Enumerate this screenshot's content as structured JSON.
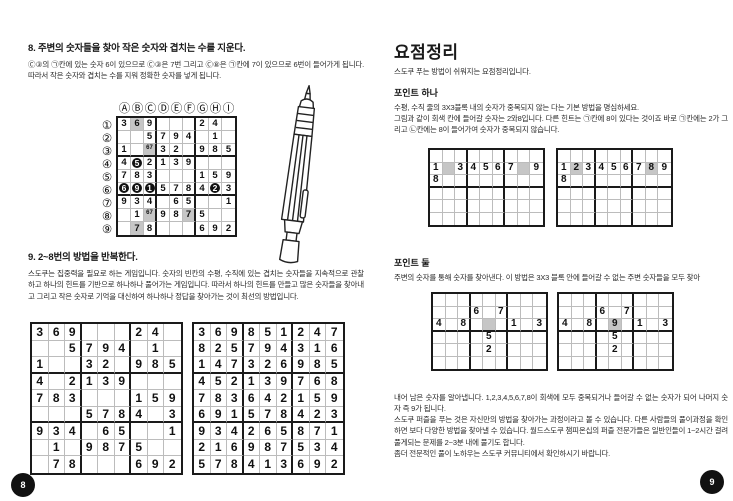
{
  "colors": {
    "shaded_cell": "#c6c6c6",
    "black_disc": "#111111",
    "page_badge": "#111111"
  },
  "left_page": {
    "section8": {
      "heading": "8. 주변의 숫자들을 찾아 작은 숫자와 겹치는 수를 지운다.",
      "body": "Ⓒ③의 ㉠칸에 있는 숫자 6이 있으므로 Ⓒ③은 7번 그리고 Ⓒ⑧은 ㉠칸에 7이 있으므로 6번이 들어가게 됩니다. 따라서 작은 숫자와 겹치는 수를 지워 정확한 숫자를 넣게 됩니다."
    },
    "labeled_grid": {
      "col_headers": [
        "Ⓐ",
        "Ⓑ",
        "Ⓒ",
        "Ⓓ",
        "Ⓔ",
        "Ⓕ",
        "Ⓖ",
        "Ⓗ",
        "Ⓘ"
      ],
      "row_headers": [
        "①",
        "②",
        "③",
        "④",
        "⑤",
        "⑥",
        "⑦",
        "⑧",
        "⑨"
      ],
      "cells": [
        [
          "3",
          "6",
          "9",
          "",
          "",
          "",
          "2",
          "4",
          ""
        ],
        [
          "",
          "",
          "5",
          "7",
          "9",
          "4",
          "",
          "1",
          ""
        ],
        [
          "1",
          "",
          "",
          "3",
          "2",
          "",
          "9",
          "8",
          "5"
        ],
        [
          "4",
          "5",
          "2",
          "1",
          "3",
          "9",
          "",
          "",
          ""
        ],
        [
          "7",
          "8",
          "3",
          "",
          "",
          "",
          "1",
          "5",
          "9"
        ],
        [
          "6",
          "9",
          "1",
          "5",
          "7",
          "8",
          "4",
          "2",
          "3"
        ],
        [
          "9",
          "3",
          "4",
          "",
          "6",
          "5",
          "",
          "",
          "1"
        ],
        [
          "",
          "1",
          "",
          "9",
          "8",
          "7",
          "5",
          "",
          ""
        ],
        [
          "",
          "7",
          "8",
          "",
          "",
          "",
          "6",
          "9",
          "2"
        ]
      ],
      "shaded": [
        [
          0,
          1
        ],
        [
          2,
          2
        ],
        [
          7,
          2
        ],
        [
          7,
          5
        ],
        [
          8,
          1
        ]
      ],
      "black": [
        [
          3,
          1
        ],
        [
          5,
          0
        ],
        [
          5,
          1
        ],
        [
          5,
          2
        ],
        [
          5,
          7
        ]
      ],
      "marks": [
        [
          2,
          2,
          "67"
        ],
        [
          7,
          2,
          "67"
        ]
      ]
    },
    "section9": {
      "heading": "9. 2~8번의 방법을 반복한다.",
      "body": "스도쿠는 집중력을 필요로 하는 게임입니다. 숫자의 빈칸의 수평, 수직에 있는 겹치는 숫자들을 지속적으로 관찰하고 하나의 힌트를 기반으로 하나하나 풀어가는 게임입니다. 따라서 하나의 힌트를 만들고 많은 숫자들을 찾아내고 그리고 작은 숫자로 기억을 대신하여 하나하나 정답을 찾아가는 것이 최선의 방법입니다."
    },
    "puzzle_grid": {
      "cells": [
        [
          "3",
          "6",
          "9",
          "",
          "",
          "",
          "2",
          "4",
          ""
        ],
        [
          "",
          "",
          "5",
          "7",
          "9",
          "4",
          "",
          "1",
          ""
        ],
        [
          "1",
          "",
          "",
          "3",
          "2",
          "",
          "9",
          "8",
          "5"
        ],
        [
          "4",
          "",
          "2",
          "1",
          "3",
          "9",
          "",
          "",
          ""
        ],
        [
          "7",
          "8",
          "3",
          "",
          "",
          "",
          "1",
          "5",
          "9"
        ],
        [
          "",
          "",
          "",
          "5",
          "7",
          "8",
          "4",
          "",
          "3"
        ],
        [
          "9",
          "3",
          "4",
          "",
          "6",
          "5",
          "",
          "",
          "1"
        ],
        [
          "",
          "1",
          "",
          "9",
          "8",
          "7",
          "5",
          "",
          ""
        ],
        [
          "",
          "7",
          "8",
          "",
          "",
          "",
          "6",
          "9",
          "2"
        ]
      ]
    },
    "solution_grid": {
      "cells": [
        [
          "3",
          "6",
          "9",
          "8",
          "5",
          "1",
          "2",
          "4",
          "7"
        ],
        [
          "8",
          "2",
          "5",
          "7",
          "9",
          "4",
          "3",
          "1",
          "6"
        ],
        [
          "1",
          "4",
          "7",
          "3",
          "2",
          "6",
          "9",
          "8",
          "5"
        ],
        [
          "4",
          "5",
          "2",
          "1",
          "3",
          "9",
          "7",
          "6",
          "8"
        ],
        [
          "7",
          "8",
          "3",
          "6",
          "4",
          "2",
          "1",
          "5",
          "9"
        ],
        [
          "6",
          "9",
          "1",
          "5",
          "7",
          "8",
          "4",
          "2",
          "3"
        ],
        [
          "9",
          "3",
          "4",
          "2",
          "6",
          "5",
          "8",
          "7",
          "1"
        ],
        [
          "2",
          "1",
          "6",
          "9",
          "8",
          "7",
          "5",
          "3",
          "4"
        ],
        [
          "5",
          "7",
          "8",
          "4",
          "1",
          "3",
          "6",
          "9",
          "2"
        ]
      ]
    },
    "page_number": "8"
  },
  "right_page": {
    "title": "요점정리",
    "subtitle": "스도쿠 푸는 방법이 쉬워지는 요점정리입니다.",
    "point1": {
      "heading": "포인트 하나",
      "line1": "수평, 수직 줄의 3X3블록 내의 숫자가 중복되지 않는 다는 기본 방법을 명심하세요.",
      "line2": "그림과 같이 회색 칸에 들어갈 숫자는 2와8입니다. 다른 힌트는 ㉠칸에 8이 있다는 것이죠 바로 ㉠칸에는 2가 그리고 ㉡칸에는 8이 들어가여 숫자가 중복되지 않습니다."
    },
    "point1_grid_a": {
      "cells": [
        [
          "",
          "",
          "",
          "",
          "",
          "",
          "",
          "",
          ""
        ],
        [
          "1",
          "",
          "3",
          "4",
          "5",
          "6",
          "7",
          "",
          "9"
        ],
        [
          "8",
          "",
          "",
          "",
          "",
          "",
          "",
          "",
          ""
        ],
        [
          "",
          "",
          "",
          "",
          "",
          "",
          "",
          "",
          ""
        ],
        [
          "",
          "",
          "",
          "",
          "",
          "",
          "",
          "",
          ""
        ],
        [
          "",
          "",
          "",
          "",
          "",
          "",
          "",
          "",
          ""
        ]
      ],
      "shaded": [
        [
          1,
          1
        ],
        [
          1,
          7
        ]
      ]
    },
    "point1_grid_b": {
      "cells": [
        [
          "",
          "",
          "",
          "",
          "",
          "",
          "",
          "",
          ""
        ],
        [
          "1",
          "2",
          "3",
          "4",
          "5",
          "6",
          "7",
          "8",
          "9"
        ],
        [
          "8",
          "",
          "",
          "",
          "",
          "",
          "",
          "",
          ""
        ],
        [
          "",
          "",
          "",
          "",
          "",
          "",
          "",
          "",
          ""
        ],
        [
          "",
          "",
          "",
          "",
          "",
          "",
          "",
          "",
          ""
        ],
        [
          "",
          "",
          "",
          "",
          "",
          "",
          "",
          "",
          ""
        ]
      ],
      "shaded": [
        [
          1,
          1
        ],
        [
          1,
          7
        ]
      ]
    },
    "point2": {
      "heading": "포인트 둘",
      "body": "주변의 숫자를 통해 숫자를 찾아낸다. 이 방법은 3X3 블록 안에 들어갈 수 없는 주변 숫자들을 모두 찾아"
    },
    "point2_grid_a": {
      "cells": [
        [
          "",
          "",
          "",
          "",
          "",
          "",
          "",
          "",
          ""
        ],
        [
          "",
          "",
          "",
          "6",
          "",
          "7",
          "",
          "",
          ""
        ],
        [
          "4",
          "",
          "8",
          "",
          "",
          "",
          "1",
          "",
          "3"
        ],
        [
          "",
          "",
          "",
          "",
          "5",
          "",
          "",
          "",
          ""
        ],
        [
          "",
          "",
          "",
          "",
          "2",
          "",
          "",
          "",
          ""
        ],
        [
          "",
          "",
          "",
          "",
          "",
          "",
          "",
          "",
          ""
        ]
      ],
      "shaded": [
        [
          2,
          4
        ]
      ]
    },
    "point2_grid_b": {
      "cells": [
        [
          "",
          "",
          "",
          "",
          "",
          "",
          "",
          "",
          ""
        ],
        [
          "",
          "",
          "",
          "6",
          "",
          "7",
          "",
          "",
          ""
        ],
        [
          "4",
          "",
          "8",
          "",
          "9",
          "",
          "1",
          "",
          "3"
        ],
        [
          "",
          "",
          "",
          "",
          "5",
          "",
          "",
          "",
          ""
        ],
        [
          "",
          "",
          "",
          "",
          "2",
          "",
          "",
          "",
          ""
        ],
        [
          "",
          "",
          "",
          "",
          "",
          "",
          "",
          "",
          ""
        ]
      ],
      "shaded": [
        [
          2,
          4
        ]
      ]
    },
    "closing": {
      "p1": "내어 남은 숫자를 알아냅니다. 1,2,3,4,5,6,7,8이 회색에 모두 중복되거나 들어갈 수 없는 숫자가 되어 나머지 숫자 즉 9가 됩니다.",
      "p2": "스도쿠 퍼즐을 푸는 것은 자신만의 방법을 찾아가는 과정이라고 볼 수 있습니다. 다른 사람들의 풀이과정을 확인하면 보다 다양한 방법을 찾아낼 수 있습니다. 월드스도쿠 챔피온십의 퍼즐 전문가들은 일반인들이 1~2시간 걸려 풀게되는 문제를 2~3분 내에 풀기도 합니다.",
      "p3": "좀더 전문적인 풀이 노하우는 스도쿠 커뮤니티에서 확인하시기 바랍니다."
    },
    "page_number": "9"
  }
}
